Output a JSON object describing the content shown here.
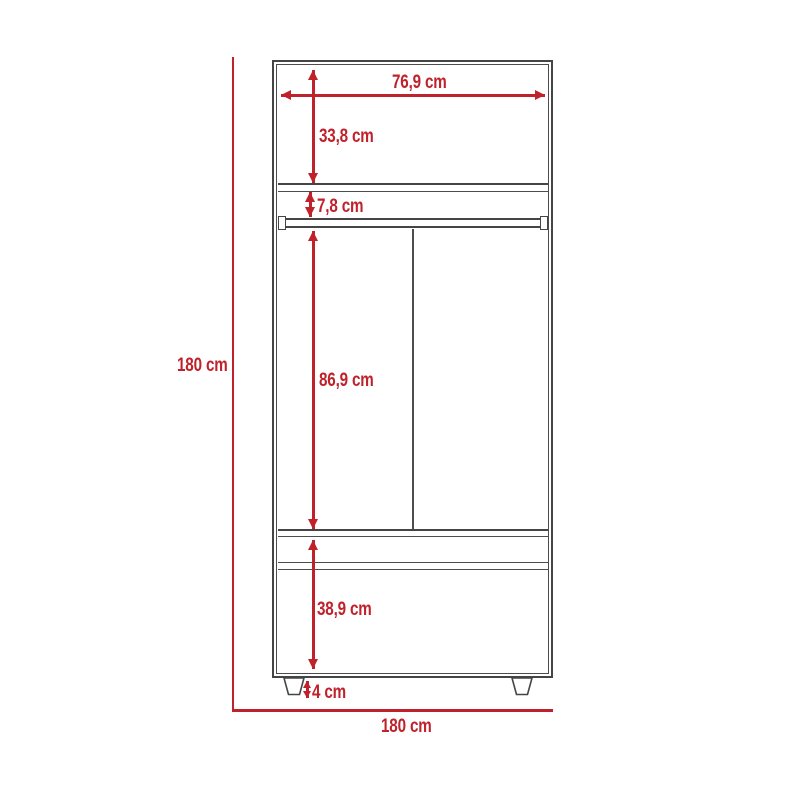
{
  "diagram": {
    "type": "furniture-dimension-drawing",
    "subject": "two-door wardrobe with drawer, front elevation",
    "unit": "cm",
    "colors": {
      "dimension_red": "#c0222c",
      "outline_gray": "#454545",
      "background": "#ffffff"
    },
    "labels": {
      "top_width": "76,9 cm",
      "upper_section_height": "33,8 cm",
      "rod_gap_height": "7,8 cm",
      "hanging_section_height": "86,9 cm",
      "drawer_section_height": "38,9 cm",
      "leg_height": "4 cm",
      "overall_height": "180 cm",
      "overall_width": "180 cm"
    }
  }
}
